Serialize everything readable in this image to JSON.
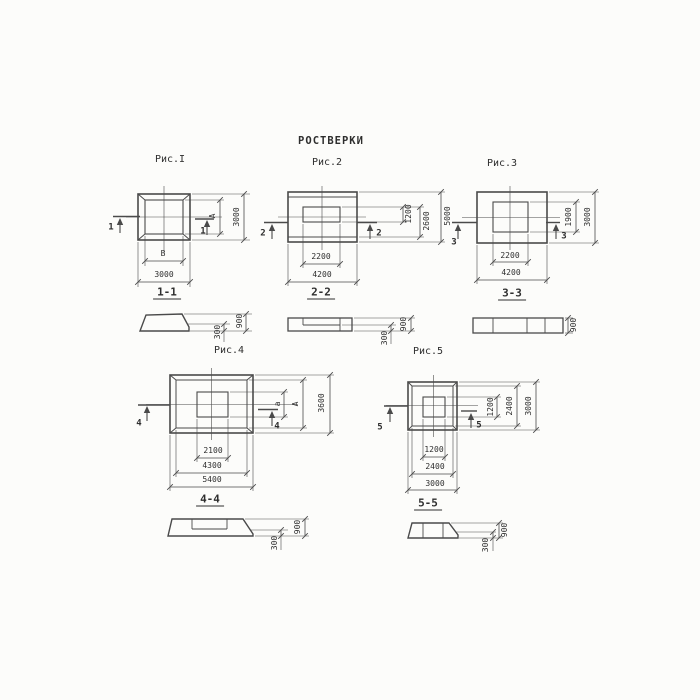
{
  "title": "РОСТВЕРКИ",
  "colors": {
    "background": "#fcfcfa",
    "line": "#4a4a4a",
    "text": "#2e2e2e"
  },
  "figures": [
    {
      "caption": "Рис.I",
      "marker": "1",
      "plan": {
        "bottom_inner": "В",
        "bottom_outer": "3000",
        "right_inner": "А",
        "right_outer": "3000"
      },
      "section": {
        "label": "1-1",
        "height_total": "900",
        "height_edge": "300"
      }
    },
    {
      "caption": "Рис.2",
      "marker": "2",
      "plan": {
        "bottom_inner": "2200",
        "bottom_outer": "4200",
        "right_inner": "1200",
        "right_middle": "2600",
        "right_outer": "5000"
      },
      "section": {
        "label": "2-2",
        "height_total": "900",
        "height_edge": "300"
      }
    },
    {
      "caption": "Рис.3",
      "marker": "3",
      "plan": {
        "bottom_inner": "2200",
        "bottom_outer": "4200",
        "right_inner": "1900",
        "right_outer": "3000"
      },
      "section": {
        "label": "3-3",
        "height_total": "900"
      }
    },
    {
      "caption": "Рис.4",
      "marker": "4",
      "plan": {
        "bottom_inner": "2100",
        "bottom_middle": "4300",
        "bottom_outer": "5400",
        "right_inner": "а",
        "right_middle": "А",
        "right_outer": "3600"
      },
      "section": {
        "label": "4-4",
        "height_total": "900",
        "height_edge": "300"
      }
    },
    {
      "caption": "Рис.5",
      "marker": "5",
      "plan": {
        "bottom_inner": "1200",
        "bottom_middle": "2400",
        "bottom_outer": "3000",
        "right_inner": "1200",
        "right_middle": "2400",
        "right_outer": "3000"
      },
      "section": {
        "label": "5-5",
        "height_total": "900",
        "height_edge": "300"
      }
    }
  ]
}
